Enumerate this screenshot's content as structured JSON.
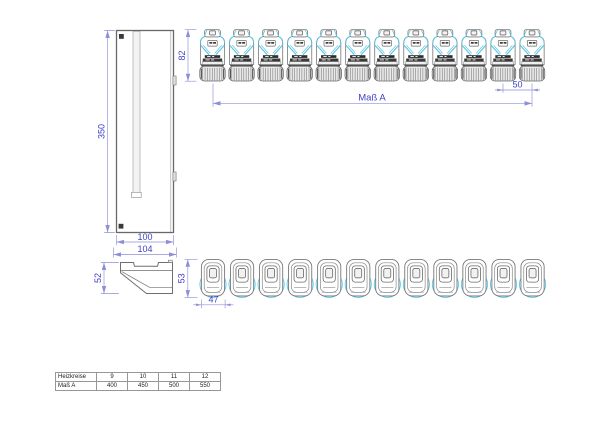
{
  "title": "Verteilerschrank Zeichnung",
  "colors": {
    "dimension_line": "#8f8fd8",
    "dimension_text": "#3f3fc6",
    "outline": "#6f6f6f",
    "accent_cyan": "#55c5e5",
    "dark_detail": "#3a3a3a",
    "background": "#ffffff"
  },
  "views": {
    "cabinet_side": {
      "dim_height": "350",
      "dim_width_inner": "100",
      "dim_width_outer": "104"
    },
    "cabinet_top_profile": {
      "dim_height": "52"
    },
    "actuator_row_front": {
      "count": 12,
      "dim_height": "82",
      "dim_pitch": "50",
      "dim_span_label": "Maß A"
    },
    "actuator_row_top": {
      "count": 12,
      "dim_height": "53",
      "dim_width": "47"
    }
  },
  "table": {
    "rows": [
      {
        "label": "Heizkreise",
        "values": [
          "9",
          "10",
          "11",
          "12"
        ]
      },
      {
        "label": "Maß A",
        "values": [
          "400",
          "450",
          "500",
          "550"
        ]
      }
    ]
  }
}
